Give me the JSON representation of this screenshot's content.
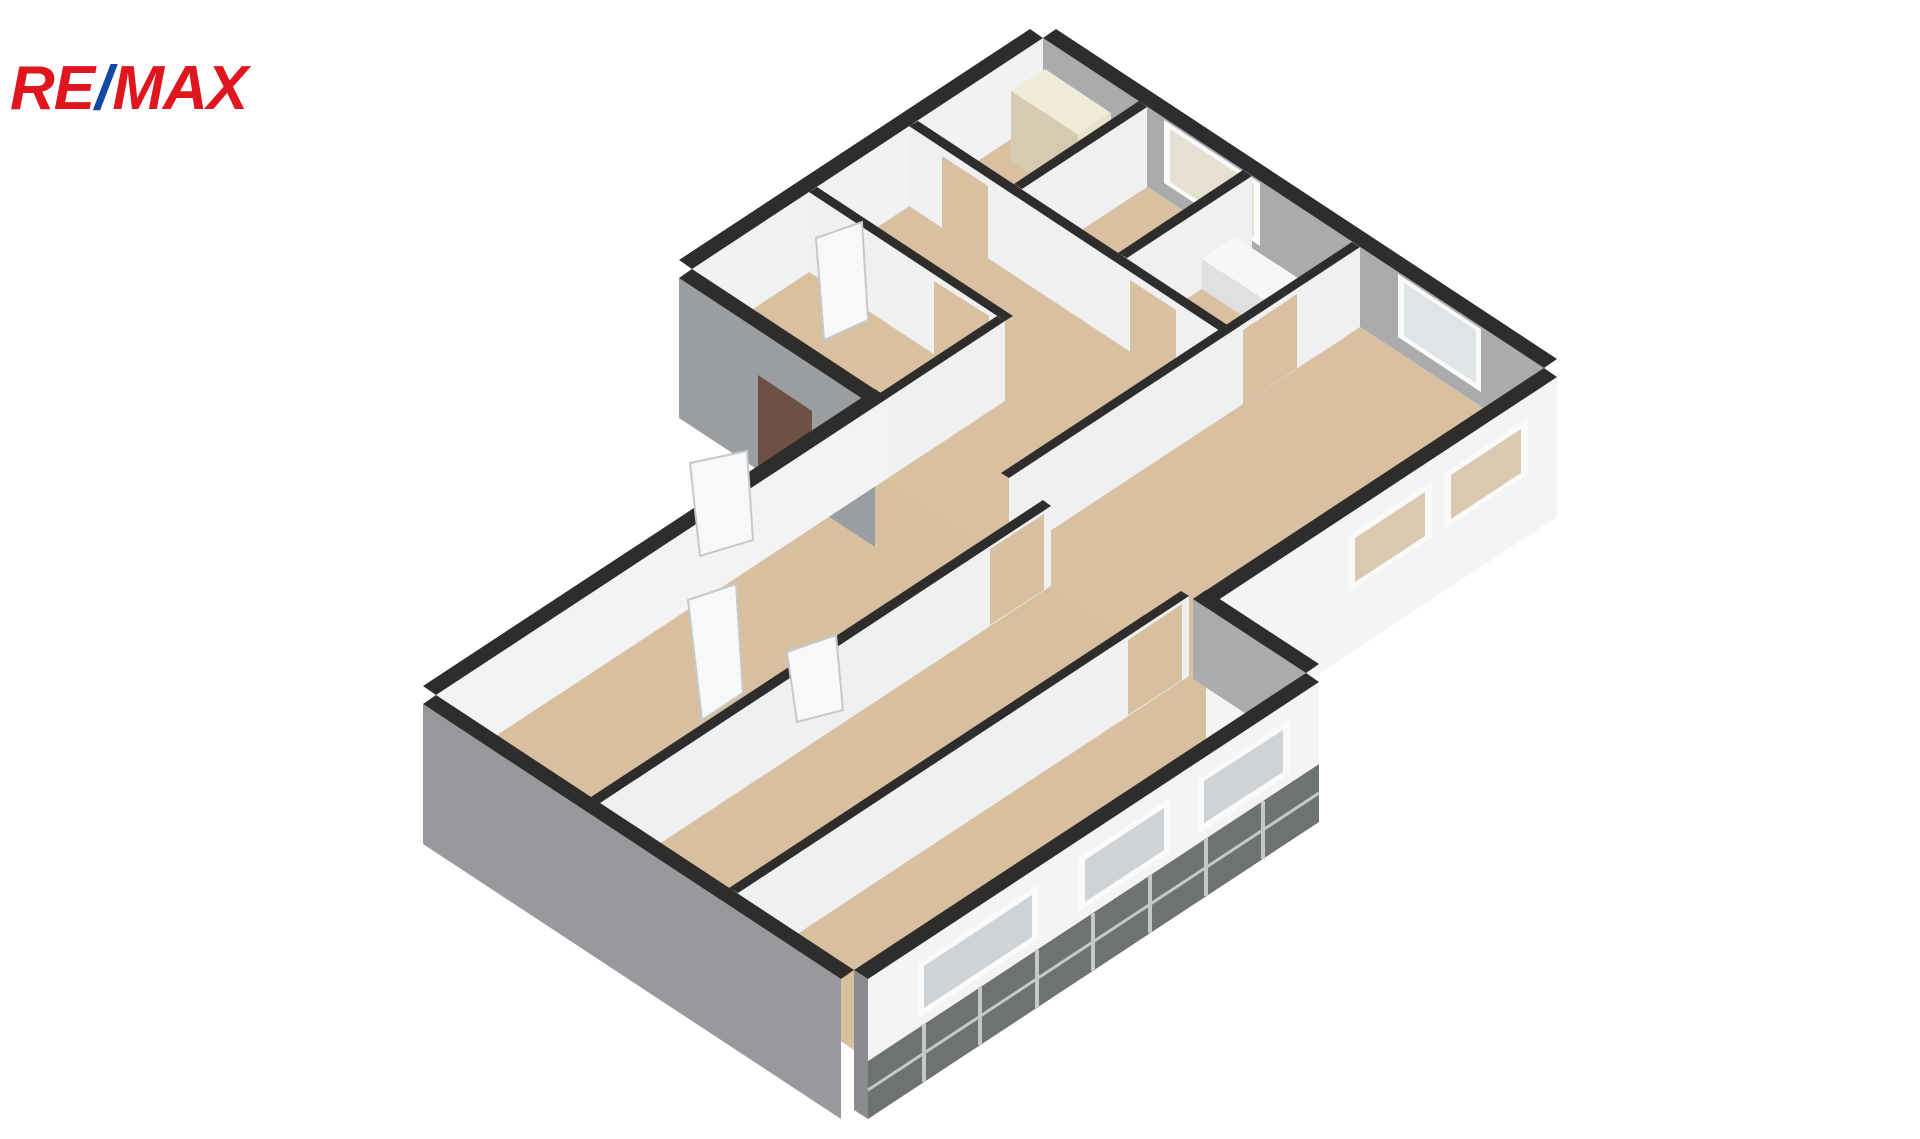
{
  "page": {
    "title": "3D floor plan – apartment axonometric view",
    "background": "#ffffff",
    "width": 1920,
    "height": 1139
  },
  "logo": {
    "re": "RE",
    "slash": "/",
    "max": "MAX",
    "red": "#e0161f",
    "blue": "#1547a5"
  },
  "floorplan": {
    "type": "isometric-3d-floor-plan",
    "palette": {
      "wall_cap": "#2e2d2b",
      "wall_white": "#f1f2f4",
      "wall_gray_interior": "#a9abad",
      "wall_gray_exterior": "#9b9ea1",
      "floor_beige": "#d9c0a1",
      "plinth_tile": "#6e7370",
      "tile_joint": "#c5c8c6",
      "entry_door_brown": "#6f5047",
      "window_glass": "#cdd3d6",
      "window_frame": "#fafafa"
    },
    "shapes": [
      {
        "n": "floor-upper-wing",
        "f": "#d9c0a1",
        "p": "1043,118 1544,448 1193,679 692,349"
      },
      {
        "n": "floor-lower-wing",
        "f": "#d8bfa0",
        "p": "888,478 1306,753 854,1050 436,775"
      },
      {
        "n": "wall-ne-inner",
        "f": "#a9abad",
        "p": "1043,38 1544,368 1544,448 1043,118"
      },
      {
        "n": "window-ne-1-frame",
        "f": "#fafafa",
        "p": "1164,120 1260,183 1260,246 1164,183"
      },
      {
        "n": "window-ne-1-glass",
        "f": "#e6e0d2",
        "p": "1170,129 1254,184 1254,237 1170,182"
      },
      {
        "n": "window-ne-2-frame",
        "f": "#fafafa",
        "p": "1398,274 1481,329 1481,392 1398,337"
      },
      {
        "n": "window-ne-2-glass",
        "f": "#dfe4e7",
        "p": "1404,283 1476,330 1476,383 1404,336"
      },
      {
        "n": "wall-ne-cap",
        "f": "#2e2d2b",
        "p": "1056,29 1557,359 1544,368 1043,38"
      },
      {
        "n": "wall-nw-inner",
        "f": "#f1f2f4",
        "p": "1043,38 692,269 692,349 1043,118"
      },
      {
        "n": "wall-nw-cap",
        "f": "#2e2d2b",
        "p": "1030,29 1043,38 692,269 679,260"
      },
      {
        "n": "cabinet-top",
        "f": "#f0ead9",
        "p": "1045,69 1111,113 1078,135 1011,91"
      },
      {
        "n": "cabinet-front",
        "f": "#e9e1cb",
        "p": "1111,113 1078,135 1078,205 1111,183"
      },
      {
        "n": "cabinet-side",
        "f": "#d6cbb1",
        "p": "1011,91 1078,135 1078,205 1011,161"
      },
      {
        "n": "partition-p3-face",
        "f": "#eff0f2",
        "p": "1147,107 1022,189 1022,269 1147,187"
      },
      {
        "n": "partition-p3-cap",
        "f": "#2e2d2b",
        "p": "1139,101 1014,184 1022,189 1147,107"
      },
      {
        "n": "partition-p4-face",
        "f": "#eff0f2",
        "p": "1252,176 1127,258 1127,338 1252,256"
      },
      {
        "n": "partition-p4-cap",
        "f": "#2e2d2b",
        "p": "1243,170 1118,253 1127,258 1252,176"
      },
      {
        "n": "bathtub-top",
        "f": "#f7f7f8",
        "p": "1235,237 1344,308 1310,330 1202,259"
      },
      {
        "n": "bathtub-front",
        "f": "#eceded",
        "p": "1344,308 1310,330 1310,360 1344,338"
      },
      {
        "n": "bathtub-side",
        "f": "#dfe0e2",
        "p": "1202,259 1310,330 1310,360 1202,289"
      },
      {
        "n": "partition-p1-face",
        "f": "#eff0f2",
        "p": "909,126 1226,335 1226,415 909,206"
      },
      {
        "n": "p1-door-gap-1",
        "f": "#d9c0a1",
        "p": "942,156 988,186 988,258 942,228"
      },
      {
        "n": "p1-door-gap-2",
        "f": "#d9c0a1",
        "p": "1130,280 1176,310 1176,382 1130,352"
      },
      {
        "n": "partition-p1-cap",
        "f": "#2e2d2b",
        "p": "918,121 1235,330 1226,335 909,126"
      },
      {
        "n": "partition-p5-face",
        "f": "#eff0f2",
        "p": "809,192 1005,321 1005,401 809,272"
      },
      {
        "n": "p5-door-gap",
        "f": "#d9c0a1",
        "p": "934,281 989,316 989,390 934,355"
      },
      {
        "n": "partition-p5-cap",
        "f": "#2e2d2b",
        "p": "817,187 1013,316 1005,321 809,192"
      },
      {
        "n": "door-panel-entry",
        "f": "#f7f8f9",
        "s": "#c6c8ca",
        "p": "816,238 862,222 868,320 824,340"
      },
      {
        "n": "partition-p6-face",
        "f": "#eff0f2",
        "p": "1005,321 888,398 888,478 1005,401"
      },
      {
        "n": "partition-p6-cap",
        "f": "#2e2d2b",
        "p": "997,316 880,393 888,398 1005,321"
      },
      {
        "n": "partition-p2-face",
        "f": "#eff0f2",
        "p": "1360,247 1009,478 1009,558 1360,327"
      },
      {
        "n": "p2-door-gap",
        "f": "#d9c0a1",
        "p": "1297,294 1243,330 1243,404 1297,368"
      },
      {
        "n": "partition-p2-cap",
        "f": "#2e2d2b",
        "p": "1352,242 1001,473 1009,478 1360,247"
      },
      {
        "n": "facade-se-upper",
        "f": "#f4f4f6",
        "p": "1557,377 1206,608 1206,748 1557,517"
      },
      {
        "n": "window-se-upper-1-frame",
        "f": "#fafafa",
        "p": "1528,418 1444,473 1444,529 1528,474"
      },
      {
        "n": "window-se-upper-1-glass",
        "f": "#d9c9b1",
        "p": "1521,429 1451,475 1451,519 1521,473"
      },
      {
        "n": "window-se-upper-2-frame",
        "f": "#fafafa",
        "p": "1432,481 1348,536 1348,592 1432,537"
      },
      {
        "n": "window-se-upper-2-glass",
        "f": "#d9c9b1",
        "p": "1425,492 1355,538 1355,582 1425,536"
      },
      {
        "n": "facade-se-upper-cap",
        "f": "#2e2d2b",
        "p": "1544,368 1557,377 1206,608 1193,599"
      },
      {
        "n": "wall-sw-upper-exterior",
        "f": "#9b9ea1",
        "p": "679,278 875,407 875,547 679,418"
      },
      {
        "n": "entry-door",
        "f": "#6f5047",
        "p": "758,375 812,411 812,501 758,465"
      },
      {
        "n": "wall-sw-upper-cap",
        "f": "#2e2d2b",
        "p": "692,269 679,278 875,407 888,398"
      },
      {
        "n": "wall-nw-lower",
        "f": "#f2f3f5",
        "p": "888,398 436,695 436,775 888,478"
      },
      {
        "n": "wall-nw-lower-cap",
        "f": "#2e2d2b",
        "p": "875,389 423,686 436,695 888,398"
      },
      {
        "n": "door-panel-outside",
        "f": "#f7f8f9",
        "s": "#c6c8ca",
        "p": "690,463 747,451 753,540 700,556"
      },
      {
        "n": "door-panel-room-a",
        "f": "#f7f8f9",
        "s": "#c6c8ca",
        "p": "688,600 736,584 743,693 702,720"
      },
      {
        "n": "partition-p7-face",
        "f": "#eff0f2",
        "p": "1051,506 600,803 600,883 1051,586"
      },
      {
        "n": "p7-door-gap",
        "f": "#d8bfa0",
        "p": "1044,514 990,549 990,625 1044,590"
      },
      {
        "n": "partition-p7-cap",
        "f": "#2e2d2b",
        "p": "1043,500 591,797 600,803 1051,506"
      },
      {
        "n": "door-panel-room-b",
        "f": "#f7f8f9",
        "s": "#c6c8ca",
        "p": "787,652 836,635 843,710 797,722"
      },
      {
        "n": "partition-p8-face",
        "f": "#eff0f2",
        "p": "1189,596 738,893 738,973 1189,676"
      },
      {
        "n": "p8-door-gap",
        "f": "#d8bfa0",
        "p": "1182,604 1128,640 1128,715 1182,680"
      },
      {
        "n": "partition-p8-cap",
        "f": "#2e2d2b",
        "p": "1181,591 729,888 738,893 1189,596"
      },
      {
        "n": "wall-ne-lower-inner",
        "f": "#a9abad",
        "p": "1193,599 1306,673 1306,753 1193,679"
      },
      {
        "n": "wall-ne-lower-cap",
        "f": "#2e2d2b",
        "p": "1206,590 1319,664 1306,673 1193,599"
      },
      {
        "n": "facade-plinth-tiles",
        "f": "#6e7370",
        "p": "1319,764 868,1061 868,1119 1319,822"
      },
      {
        "n": "facade-se-lower",
        "f": "#f4f4f6",
        "p": "1319,682 868,979 868,1061 1319,764"
      },
      {
        "n": "window-room-c-frame",
        "f": "#fafafa",
        "p": "1290,719 1198,780 1198,834 1290,773"
      },
      {
        "n": "window-room-c-glass",
        "f": "#cdd3d6",
        "p": "1283,730 1204,781 1204,823 1283,772"
      },
      {
        "n": "window-room-b-frame",
        "f": "#fafafa",
        "p": "1170,798 1078,858 1078,912 1170,852"
      },
      {
        "n": "window-room-b-glass",
        "f": "#cdd3d6",
        "p": "1164,808 1085,860 1085,902 1164,850"
      },
      {
        "n": "window-room-a-frame",
        "f": "#fafafa",
        "p": "1039,884 918,964 918,1018 1039,938"
      },
      {
        "n": "window-room-a-glass",
        "f": "#cdd3d6",
        "p": "1032,895 924,966 924,1008 1032,937"
      },
      {
        "n": "facade-se-lower-cap",
        "f": "#2e2d2b",
        "p": "1306,673 1319,682 868,979 854,970"
      },
      {
        "n": "facade-end-edge",
        "f": "#8a8c8f",
        "p": "854,970 868,979 868,1119 854,1110"
      },
      {
        "n": "wall-sw-lower-exterior",
        "f": "#98999c",
        "p": "423,704 841,979 841,1119 423,844"
      },
      {
        "n": "wall-sw-lower-cap",
        "f": "#2e2d2b",
        "p": "436,695 423,704 841,979 854,970"
      }
    ],
    "lines": [
      {
        "n": "tile-joint-1",
        "s": "#c5c8c6",
        "w": 4,
        "x1": 1263,
        "y1": 801,
        "x2": 1263,
        "y2": 859
      },
      {
        "n": "tile-joint-2",
        "s": "#c5c8c6",
        "w": 4,
        "x1": 1206,
        "y1": 838,
        "x2": 1206,
        "y2": 896
      },
      {
        "n": "tile-joint-3",
        "s": "#c5c8c6",
        "w": 4,
        "x1": 1150,
        "y1": 875,
        "x2": 1150,
        "y2": 933
      },
      {
        "n": "tile-joint-4",
        "s": "#c5c8c6",
        "w": 4,
        "x1": 1093,
        "y1": 913,
        "x2": 1093,
        "y2": 971
      },
      {
        "n": "tile-joint-5",
        "s": "#c5c8c6",
        "w": 4,
        "x1": 1037,
        "y1": 950,
        "x2": 1037,
        "y2": 1008
      },
      {
        "n": "tile-joint-6",
        "s": "#c5c8c6",
        "w": 4,
        "x1": 980,
        "y1": 987,
        "x2": 980,
        "y2": 1045
      },
      {
        "n": "tile-joint-7",
        "s": "#c5c8c6",
        "w": 4,
        "x1": 924,
        "y1": 1024,
        "x2": 924,
        "y2": 1082
      },
      {
        "n": "tile-joint-horizontal",
        "s": "#c5c8c6",
        "w": 3,
        "x1": 1319,
        "y1": 793,
        "x2": 868,
        "y2": 1090
      }
    ]
  }
}
